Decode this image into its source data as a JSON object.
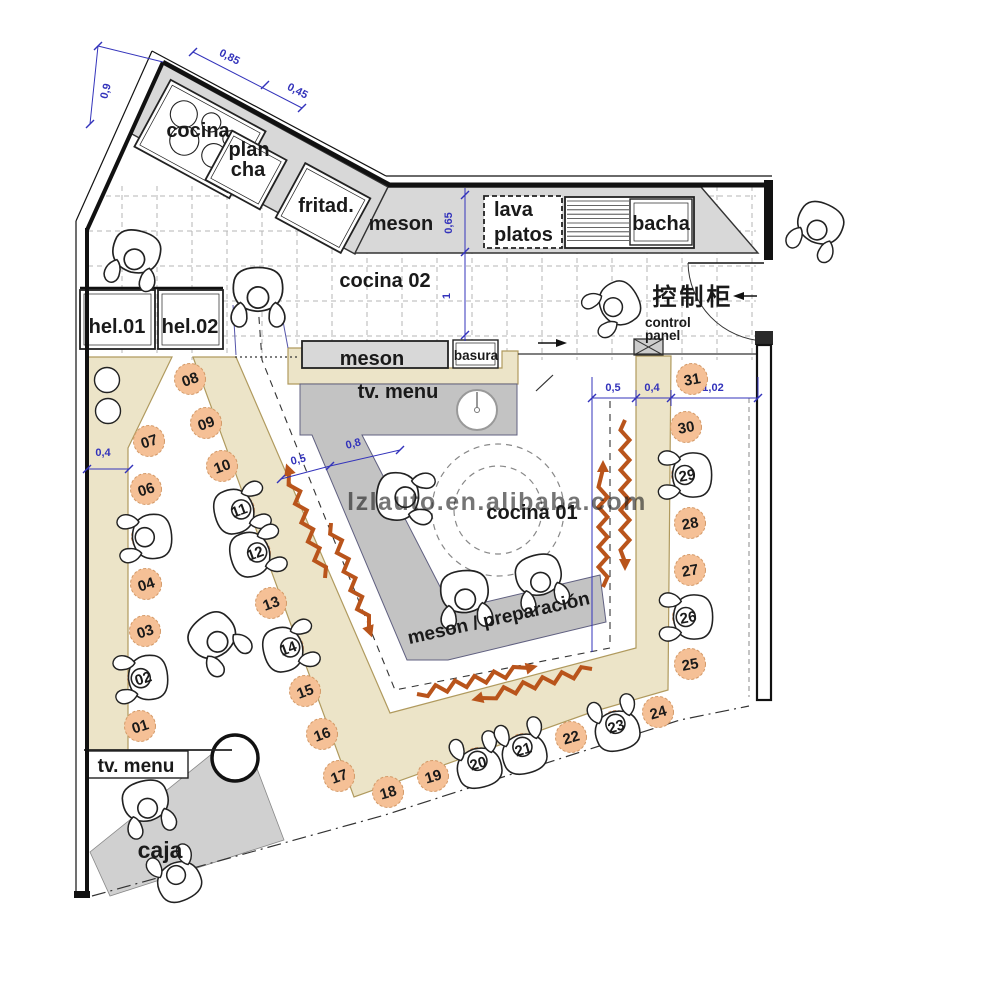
{
  "plan_title": "restaurant kitchen floor plan",
  "colors": {
    "seat": "#f5c096",
    "seat_edge": "#d49a68",
    "beige": "#ece4c8",
    "beige_edge": "#b09a5e",
    "counter_gray": "#d8d8d8",
    "island_gray": "#c3c3c3",
    "caja_gray": "#d0d0d0",
    "wall": "#111111",
    "dim_blue": "#3333bb",
    "red": "#e02020",
    "zig_orange": "#b9541b",
    "grid": "#b5b5b5",
    "watermark": "#a0a0a0"
  },
  "labels": {
    "cocina": "cocina",
    "plancha_1": "plan",
    "plancha_2": "cha",
    "fritad": "fritad.",
    "meson_top": "meson",
    "lava_1": "lava",
    "lava_2": "platos",
    "bacha": "bacha",
    "cocina02": "cocina 02",
    "hel01": "hel.01",
    "hel02": "hel.02",
    "meson_mid": "meson",
    "basura": "basura",
    "tv_menu_island": "tv. menu",
    "cocina01": "cocina 01",
    "meson_prep": "meson / preparación",
    "tv_menu_bottom": "tv. menu",
    "caja": "caja",
    "control_1": "control",
    "control_2": "panel",
    "control_cn": "控制柜",
    "watermark": "lzlauto.en.alibaba.com"
  },
  "dims": {
    "d09": "0,9",
    "d085": "0,85",
    "d045": "0,45",
    "d065": "0,65",
    "d1": "1",
    "d04_left": "0,4",
    "d05_corridor": "0,5",
    "d08": "0,8",
    "d05_right": "0,5",
    "d04_right": "0,4",
    "d102": "1,02"
  },
  "seats": [
    {
      "t": "01",
      "x": 140,
      "y": 726,
      "r": -18,
      "p": 0,
      "pr": 0,
      "sl": 1
    },
    {
      "t": "02",
      "x": 143,
      "y": 678,
      "r": -18,
      "p": 1,
      "pr": -95,
      "sl": 1
    },
    {
      "t": "03",
      "x": 145,
      "y": 631,
      "r": -18,
      "p": 0,
      "pr": 0,
      "sl": 1
    },
    {
      "t": "04",
      "x": 146,
      "y": 584,
      "r": -18,
      "p": 0,
      "pr": 0,
      "sl": 1
    },
    {
      "t": "05",
      "x": 147,
      "y": 537,
      "r": -18,
      "p": 1,
      "pr": -95,
      "sl": 0
    },
    {
      "t": "06",
      "x": 146,
      "y": 489,
      "r": -18,
      "p": 0,
      "pr": 0,
      "sl": 1
    },
    {
      "t": "07",
      "x": 149,
      "y": 441,
      "r": -18,
      "p": 0,
      "pr": 0,
      "sl": 1
    },
    {
      "t": "08",
      "x": 190,
      "y": 379,
      "r": -20,
      "p": 0,
      "pr": 0,
      "sl": 1
    },
    {
      "t": "09",
      "x": 206,
      "y": 423,
      "r": -20,
      "p": 0,
      "pr": 0,
      "sl": 1
    },
    {
      "t": "10",
      "x": 222,
      "y": 466,
      "r": -20,
      "p": 0,
      "pr": 0,
      "sl": 1
    },
    {
      "t": "11",
      "x": 239,
      "y": 510,
      "r": -20,
      "p": 1,
      "pr": 75,
      "sl": 1
    },
    {
      "t": "12",
      "x": 255,
      "y": 553,
      "r": -20,
      "p": 1,
      "pr": 75,
      "sl": 1
    },
    {
      "t": "13",
      "x": 271,
      "y": 603,
      "r": -20,
      "p": 0,
      "pr": 0,
      "sl": 1
    },
    {
      "t": "14",
      "x": 288,
      "y": 648,
      "r": -20,
      "p": 1,
      "pr": 75,
      "sl": 1
    },
    {
      "t": "15",
      "x": 305,
      "y": 691,
      "r": -20,
      "p": 0,
      "pr": 0,
      "sl": 1
    },
    {
      "t": "16",
      "x": 322,
      "y": 734,
      "r": -20,
      "p": 0,
      "pr": 0,
      "sl": 1
    },
    {
      "t": "17",
      "x": 339,
      "y": 776,
      "r": -20,
      "p": 0,
      "pr": 0,
      "sl": 1
    },
    {
      "t": "18",
      "x": 388,
      "y": 792,
      "r": -16,
      "p": 0,
      "pr": 0,
      "sl": 1
    },
    {
      "t": "19",
      "x": 433,
      "y": 776,
      "r": -16,
      "p": 0,
      "pr": 0,
      "sl": 1
    },
    {
      "t": "20",
      "x": 478,
      "y": 763,
      "r": -16,
      "p": 1,
      "pr": -15,
      "sl": 1
    },
    {
      "t": "21",
      "x": 523,
      "y": 749,
      "r": -16,
      "p": 1,
      "pr": -15,
      "sl": 1
    },
    {
      "t": "22",
      "x": 571,
      "y": 737,
      "r": -16,
      "p": 0,
      "pr": 0,
      "sl": 1
    },
    {
      "t": "23",
      "x": 616,
      "y": 726,
      "r": -16,
      "p": 1,
      "pr": -15,
      "sl": 1
    },
    {
      "t": "24",
      "x": 658,
      "y": 712,
      "r": -16,
      "p": 0,
      "pr": 0,
      "sl": 1
    },
    {
      "t": "25",
      "x": 690,
      "y": 664,
      "r": -10,
      "p": 0,
      "pr": 0,
      "sl": 1
    },
    {
      "t": "26",
      "x": 688,
      "y": 617,
      "r": -10,
      "p": 1,
      "pr": -90,
      "sl": 1
    },
    {
      "t": "27",
      "x": 690,
      "y": 570,
      "r": -10,
      "p": 0,
      "pr": 0,
      "sl": 1
    },
    {
      "t": "28",
      "x": 690,
      "y": 523,
      "r": -10,
      "p": 0,
      "pr": 0,
      "sl": 1
    },
    {
      "t": "29",
      "x": 687,
      "y": 475,
      "r": -10,
      "p": 1,
      "pr": -90,
      "sl": 1
    },
    {
      "t": "30",
      "x": 686,
      "y": 427,
      "r": -10,
      "p": 0,
      "pr": 0,
      "sl": 1
    },
    {
      "t": "31",
      "x": 692,
      "y": 379,
      "r": -10,
      "p": 0,
      "pr": 0,
      "sl": 1
    }
  ]
}
